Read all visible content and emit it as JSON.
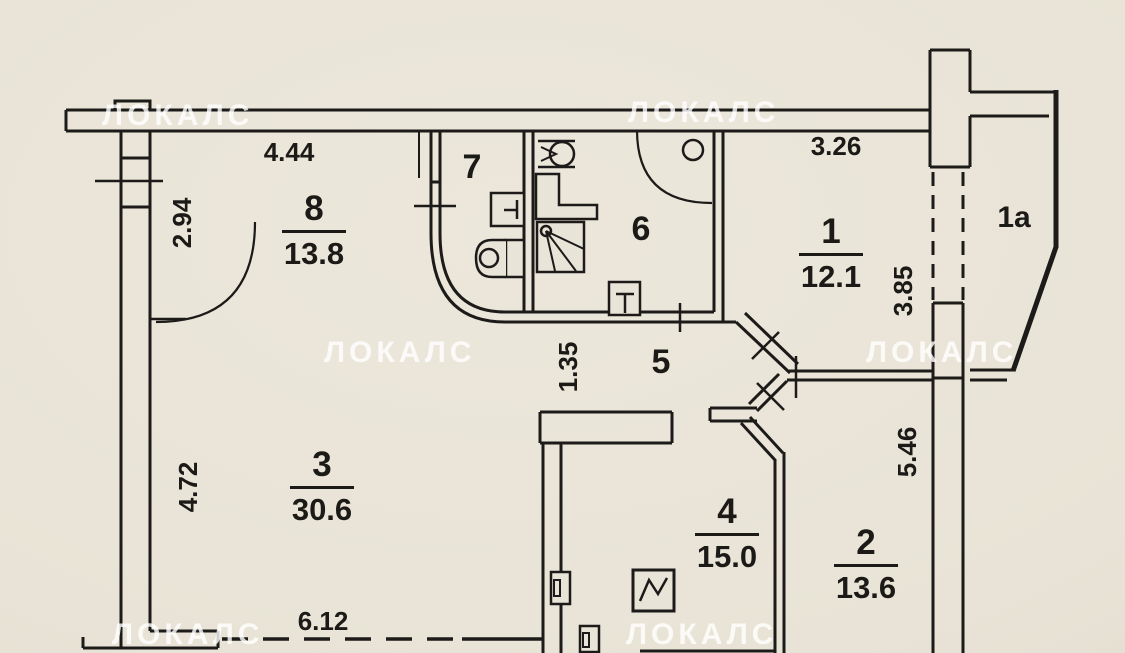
{
  "watermark": {
    "text": "ЛОКАЛС"
  },
  "rooms": [
    {
      "number": "8",
      "area": "13.8"
    },
    {
      "number": "1",
      "area": "12.1"
    },
    {
      "number": "3",
      "area": "30.6"
    },
    {
      "number": "4",
      "area": "15.0"
    },
    {
      "number": "2",
      "area": "13.6"
    }
  ],
  "labels": {
    "wc": "7",
    "bath": "6",
    "hall": "5",
    "loggia": "1a"
  },
  "dims": {
    "room8_width": "4.44",
    "room8_depth": "2.94",
    "room1_width": "3.26",
    "room1_depth": "3.85",
    "hall_width": "1.35",
    "room3_depth": "4.72",
    "room2_depth": "5.46",
    "room3_width": "6.12"
  }
}
